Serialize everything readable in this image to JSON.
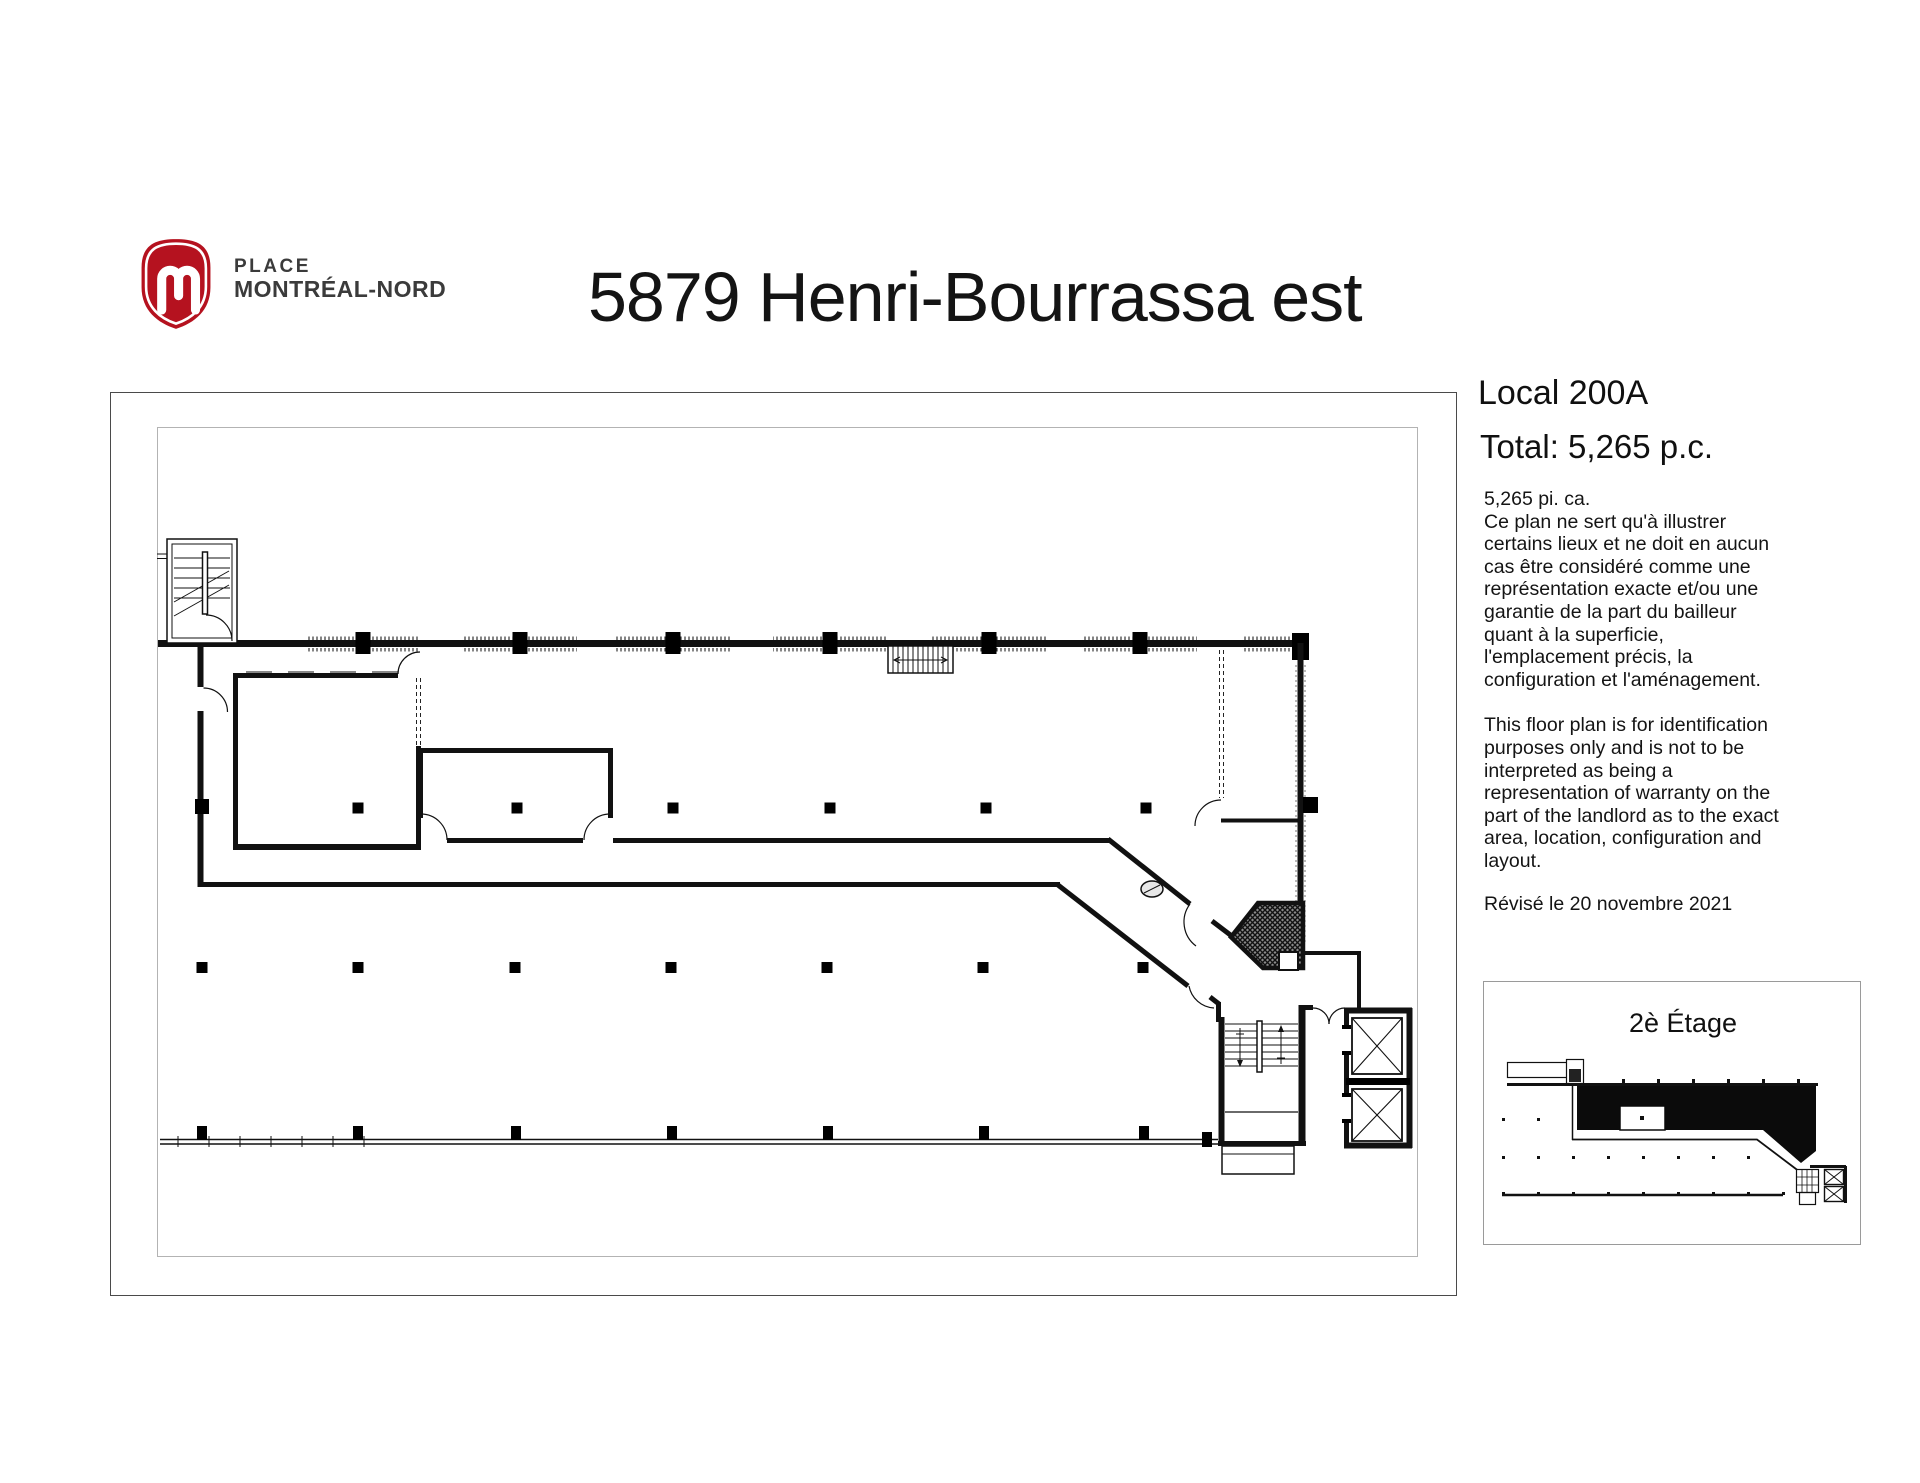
{
  "header": {
    "brand": {
      "icon": "m-shield-icon",
      "line1": "PLACE",
      "line2": "MONTRÉAL-NORD",
      "red": "#b5121f"
    },
    "title": "5879 Henri-Bourrassa est"
  },
  "info_panel": {
    "local_label": "Local 200A",
    "total_label": "Total: 5,265 p.c.",
    "area_line": "5,265  pi. ca.",
    "paragraph_fr": "Ce plan ne sert qu'à illustrer\ncertains lieux et ne doit en aucun\ncas être considéré comme une\nreprésentation exacte et/ou une\ngarantie de la part du bailleur\nquant à la superficie,\nl'emplacement précis, la\nconfiguration et l'aménagement.",
    "paragraph_en": "This floor plan is for identification\npurposes only and is not to be\ninterpreted as being a\nrepresentation of warranty on the\npart of the landlord as to the exact\narea, location, configuration and\nlayout.",
    "revised_line": "Révisé le 20 novembre 2021"
  },
  "thumbnail": {
    "title": "2è Étage"
  }
}
